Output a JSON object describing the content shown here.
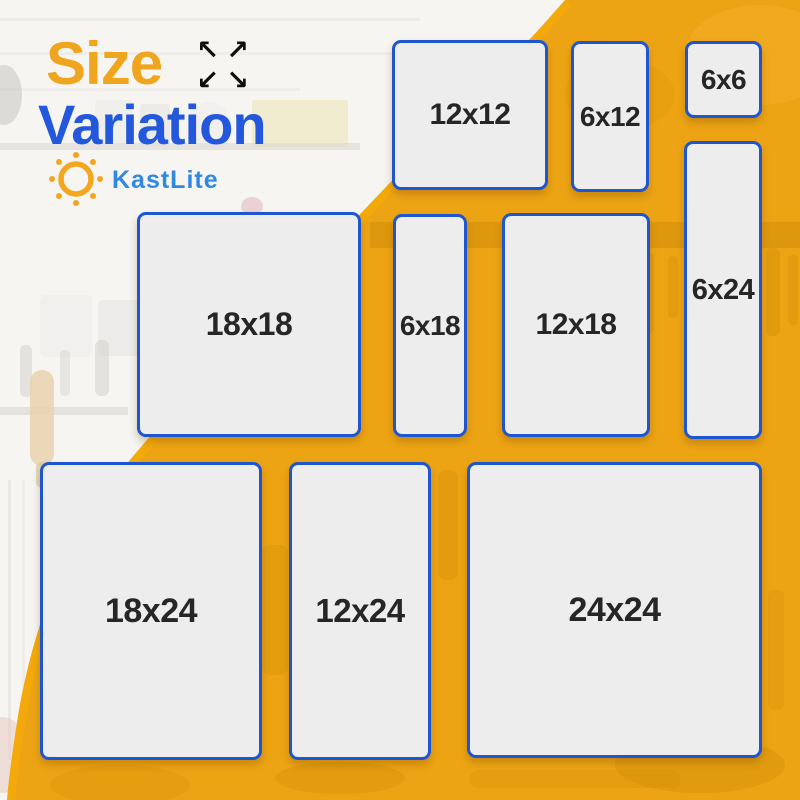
{
  "header": {
    "title_line1": "Size",
    "title_line2": "Variation",
    "arrows": [
      "↖",
      "↗",
      "↙",
      "↘"
    ],
    "brand": "KastLite"
  },
  "colors": {
    "title_orange": "#F0A51F",
    "title_blue": "#2458DC",
    "brand_blue": "#3188E2",
    "sun_orange": "#F3A61E",
    "panel_border": "#1E55D0",
    "panel_fill": "#EDEDEE",
    "label_text": "#262626",
    "background_orange": "#EDA414",
    "background_white": "#F6F5F2",
    "arrow_black": "#0E0E0E"
  },
  "sizes": {
    "items": [
      {
        "label": "12x12"
      },
      {
        "label": "6x12"
      },
      {
        "label": "6x6"
      },
      {
        "label": "6x24"
      },
      {
        "label": "18x18"
      },
      {
        "label": "6x18"
      },
      {
        "label": "12x18"
      },
      {
        "label": "18x24"
      },
      {
        "label": "12x24"
      },
      {
        "label": "24x24"
      }
    ]
  }
}
